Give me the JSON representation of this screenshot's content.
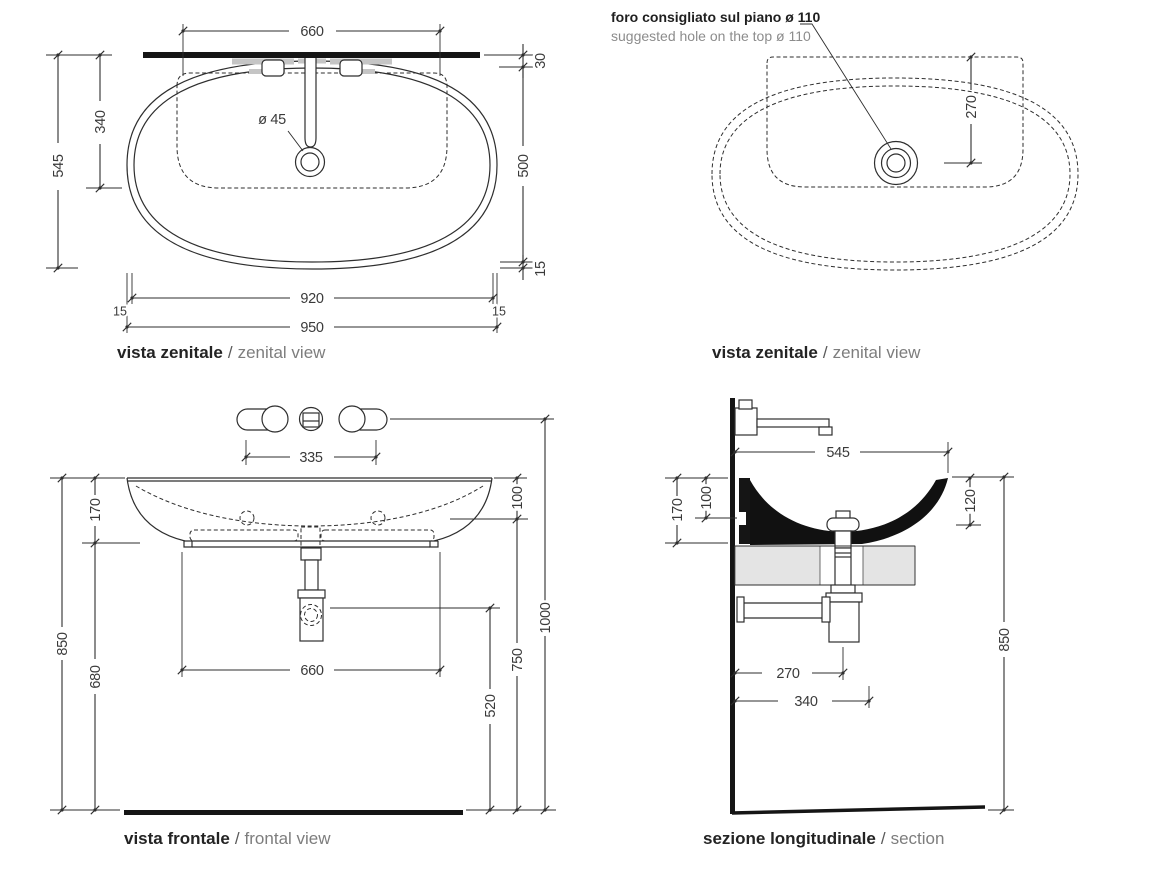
{
  "title_separator": "/",
  "views": {
    "zenital_left": {
      "title_it": "vista zenitale",
      "title_en": "zenital view",
      "dims": {
        "shelf_width": "660",
        "overall_depth": "545",
        "back_to_basin": "340",
        "drain_diameter": "ø 45",
        "back_offset": "30",
        "bowl_depth": "500",
        "front_lip": "15",
        "inner_width": "920",
        "left_lip": "15",
        "right_lip": "15",
        "overall_width": "950"
      }
    },
    "zenital_right": {
      "title_it": "vista zenitale",
      "title_en": "zenital view",
      "note_it": "foro consigliato sul piano ø 110",
      "note_en": "suggested hole on the top ø 110",
      "dims": {
        "drain_from_back": "270"
      }
    },
    "frontal": {
      "title_it": "vista frontale",
      "title_en": "frontal view",
      "dims": {
        "tap_centres": "335",
        "basin_height": "170",
        "rim_to_holes": "100",
        "rim_height": "850",
        "clearance_height": "680",
        "base_width": "660",
        "trap_height": "520",
        "holes_height": "750",
        "tap_height": "1000"
      }
    },
    "section": {
      "title_it": "sezione longitudinale",
      "title_en": "section",
      "dims": {
        "overall_depth": "545",
        "basin_height": "170",
        "rim_to_hole": "100",
        "inner_depth": "120",
        "rim_height": "850",
        "trap_from_wall": "270",
        "outlet_from_wall": "340"
      }
    }
  }
}
